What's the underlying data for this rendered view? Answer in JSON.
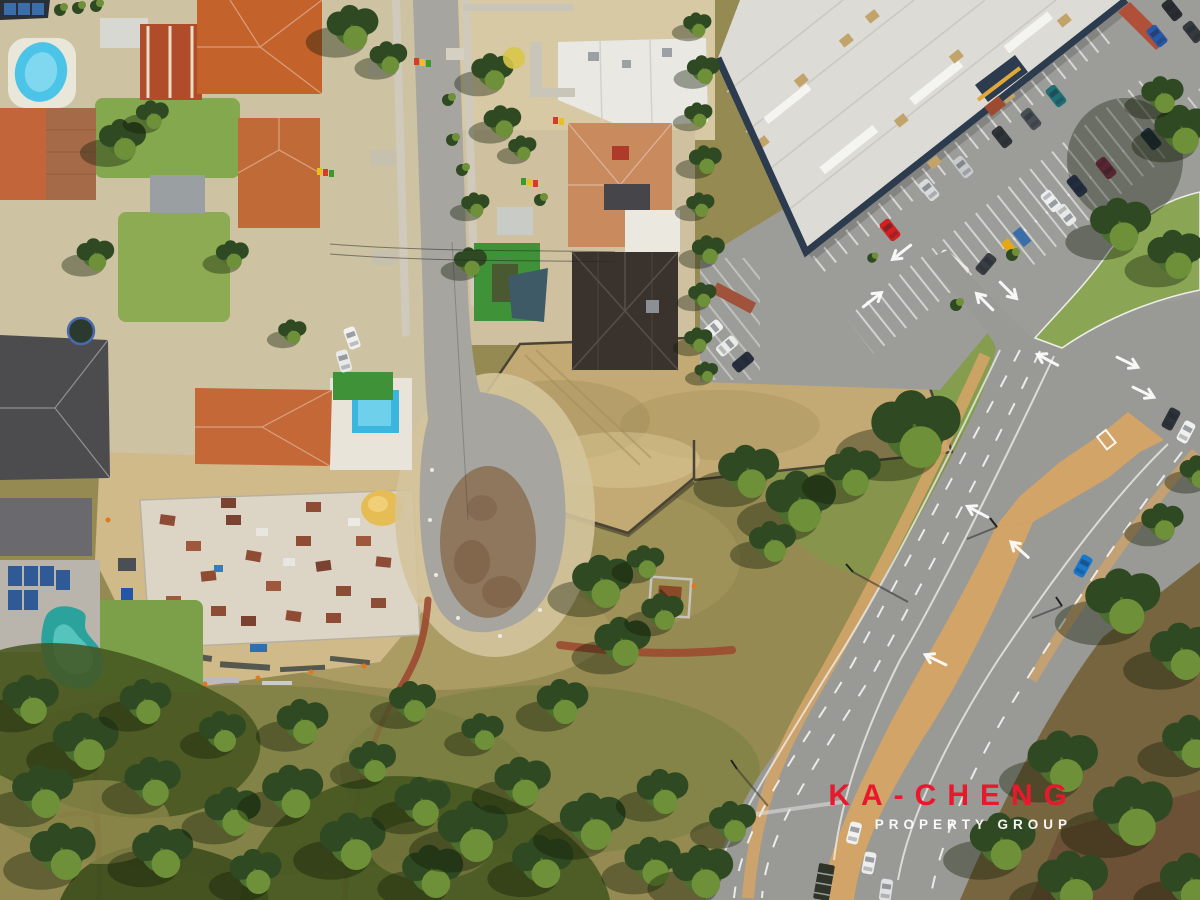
{
  "watermark": {
    "brand": "KA-CHENG",
    "tagline": "PROPERTY GROUP",
    "brand_color": "#e8182d",
    "tagline_color": "#ffffff"
  },
  "palette": {
    "brand_red": "#e8182d",
    "white": "#ffffff",
    "park_olive": "#958b52",
    "dry_field_tan": "#c3aa74",
    "lawn_green": "#84a84e",
    "turf_green": "#3f9238",
    "tree_dark": "#2f4a22",
    "tree_mid": "#4c6e2e",
    "tree_light": "#6d9039",
    "asphalt_road": "#999995",
    "asphalt_street": "#a6a5a0",
    "asphalt_parking": "#9c9c98",
    "median_tan": "#d2a468",
    "terracotta_roof": "#c4622c",
    "rust_roof": "#b04c2a",
    "tan_roof": "#c98a5e",
    "dark_roof": "#3a332d",
    "warehouse_white": "#dcdbd5",
    "warehouse_trim": "#2c3b4e",
    "pool_blue": "#4cc4e8",
    "pool_teal": "#2ba39c",
    "sand_verge": "#d4c49c",
    "concrete_slab": "#dcd5c6",
    "brick_path": "#9c4a30",
    "construction_sand": "#d0ba8a"
  },
  "scene": {
    "type": "aerial-drone-photograph",
    "setting": "suburban streets and cul-de-sac beside a shopping-centre carpark, arterial dual-carriageway road and bushland reserve",
    "features": [
      "residential houses with terracotta and dark tiled roofs",
      "backyard swimming pools (oval blue, rectangular blue, kidney teal)",
      "rooftop solar panels",
      "construction site with concrete slab, brick pallets and sand pile",
      "vacant fenced dry-grass lot",
      "white warehouse roof with navy trim and parking bays with cars",
      "grass island with large shade trees",
      "dual carriageway with orange median, lane arrows and traffic",
      "bushland park with winding red-brick path",
      "KA-CHENG PROPERTY GROUP watermark"
    ]
  }
}
